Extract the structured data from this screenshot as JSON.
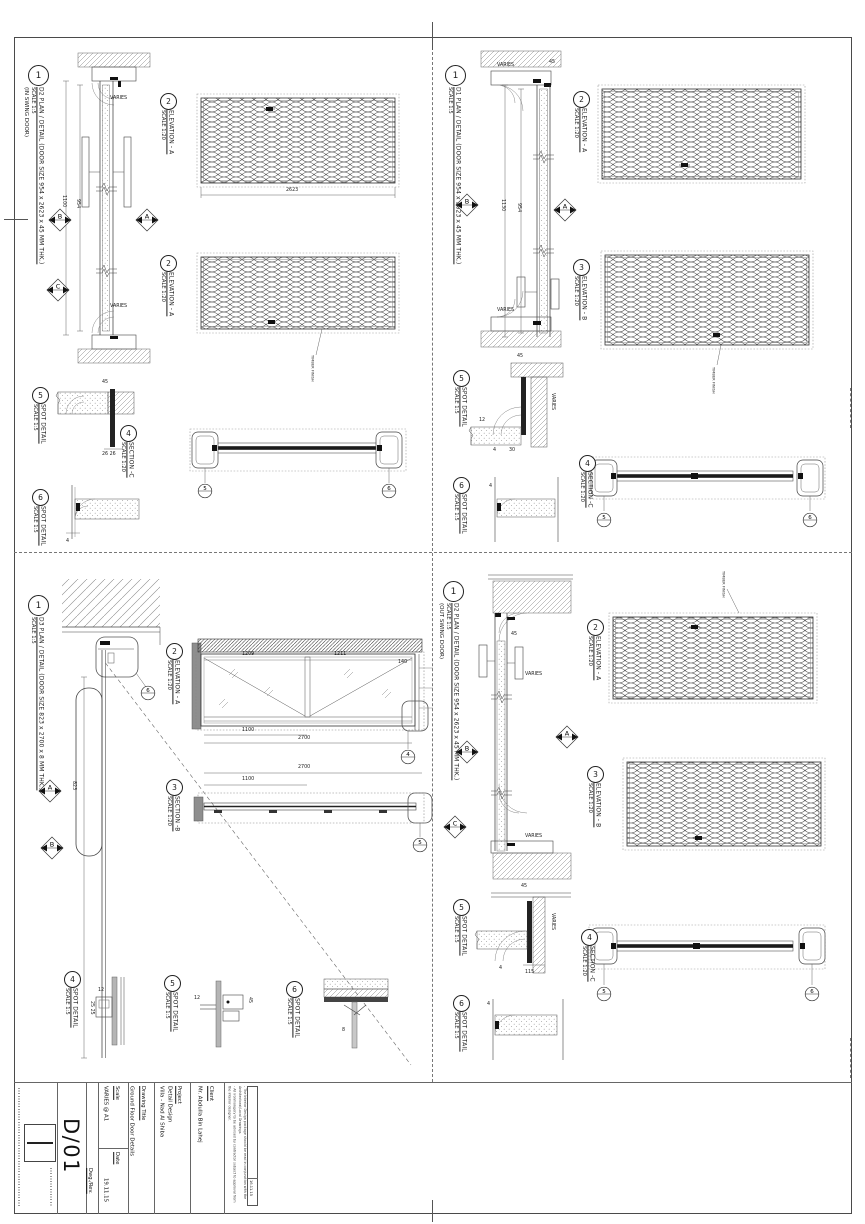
{
  "sheet": {
    "qtl": {
      "plan": {
        "num": "1",
        "title": "D2 PLAN / DETAIL (DOOR SIZE 954 x 2623 x 45 MM THK.)",
        "scale": "SCALE 1:5",
        "subtitle": "(IN SWING DOOR)"
      },
      "elev1": {
        "num": "2",
        "title": "ELEVATION - A",
        "scale": "SCALE 1:20"
      },
      "elev2": {
        "num": "2",
        "title": "ELEVATION - A",
        "scale": "SCALE 1:20"
      },
      "section": {
        "num": "4",
        "title": "SECTION -C",
        "scale": "SCALE 1:20"
      },
      "spot5": {
        "num": "5",
        "title": "SPOT DETAIL",
        "scale": "SCALE 1:5"
      },
      "spot6": {
        "num": "6",
        "title": "SPOT DETAIL",
        "scale": "SCALE 1:5"
      },
      "finish_label": "TIMBER FINISH",
      "dims": {
        "height": "1100",
        "door": "954",
        "panel": "2623",
        "varies1": "VARIES",
        "varies2": "VARIES",
        "t45": "45",
        "t26": "26  26",
        "t4": "4"
      },
      "markers": {
        "a": "A",
        "b": "B",
        "c": "C",
        "sec_left": "5",
        "sec_right": "6"
      }
    },
    "qtr": {
      "plan": {
        "num": "1",
        "title": "D1 PLAN / DETAIL (DOOR SIZE 954 x 2623 x 45 MM THK.)",
        "scale": "SCALE 1:5"
      },
      "elev1": {
        "num": "2",
        "title": "ELEVATION - A",
        "scale": "SCALE 1:20"
      },
      "elev2": {
        "num": "3",
        "title": "ELEVATION - B",
        "scale": "SCALE 1:20"
      },
      "section": {
        "num": "4",
        "title": "SECTION -C",
        "scale": "SCALE 1:20"
      },
      "spot5": {
        "num": "5",
        "title": "SPOT DETAIL",
        "scale": "SCALE 1:5"
      },
      "spot6": {
        "num": "6",
        "title": "SPOT DETAIL",
        "scale": "SCALE 1:5"
      },
      "finish_label": "TIMBER FINISH",
      "dims": {
        "height": "1130",
        "door": "954",
        "varies1": "VARIES",
        "varies2": "VARIES",
        "t45a": "45",
        "t45b": "45",
        "t12": "12",
        "t30": "30",
        "t4a": "4",
        "t4b": "4",
        "varies_spot": "VARIES"
      },
      "markers": {
        "a": "A",
        "b": "B",
        "sec_left": "5",
        "sec_right": "6"
      }
    },
    "qbl": {
      "plan": {
        "num": "1",
        "title": "D3 PLAN / DETAIL (DOOR SIZE 823 x 2700 x 8 MM THK.)",
        "scale": "SCALE 1:5"
      },
      "elev": {
        "num": "2",
        "title": "ELEVATION - A",
        "scale": "SCALE 1:20"
      },
      "section": {
        "num": "3",
        "title": "SECTION -B",
        "scale": "SCALE 1:20"
      },
      "spot4": {
        "num": "4",
        "title": "SPOT DETAIL",
        "scale": "SCALE 1:5"
      },
      "spot5": {
        "num": "5",
        "title": "SPOT DETAIL",
        "scale": "SCALE 1:5"
      },
      "spot6": {
        "num": "6",
        "title": "SPOT DETAIL",
        "scale": "SCALE 1:5"
      },
      "dims": {
        "door": "823",
        "p1": "1209",
        "p2": "1211",
        "p3": "140",
        "w1": "1100",
        "w2": "2700",
        "s1": "2700",
        "s2": "1100",
        "t12a": "12",
        "t25": "25  25",
        "t12b": "12",
        "t45": "45",
        "t8": "8"
      },
      "markers": {
        "a": "A",
        "b": "B",
        "top": "6",
        "elev": "4",
        "sec": "5"
      }
    },
    "qbr": {
      "plan": {
        "num": "1",
        "title": "D2 PLAN / DETAIL (DOOR SIZE 954 x 2623 x 45 MM THK.)",
        "scale": "SCALE 1:5",
        "subtitle": "(OUT SWING DOOR)"
      },
      "elev1": {
        "num": "2",
        "title": "ELEVATION - A",
        "scale": "SCALE 1:20"
      },
      "elev2": {
        "num": "3",
        "title": "ELEVATION - B",
        "scale": "SCALE 1:20"
      },
      "section": {
        "num": "4",
        "title": "SECTION -C",
        "scale": "SCALE 1:20"
      },
      "spot5": {
        "num": "5",
        "title": "SPOT DETAIL",
        "scale": "SCALE 1:5"
      },
      "spot6": {
        "num": "6",
        "title": "SPOT DETAIL",
        "scale": "SCALE 1:5"
      },
      "finish_label": "TIMBER FINISH",
      "dims": {
        "varies1": "VARIES",
        "varies2": "VARIES",
        "t45a": "45",
        "t45b": "45",
        "varies_spot": "VARIES",
        "t4a": "4",
        "t115": "115",
        "t4b": "4"
      },
      "markers": {
        "a": "A",
        "b": "B",
        "c": "C",
        "sec_left": "5",
        "sec_right": "6"
      }
    },
    "title_block": {
      "drawing_number": "D/01",
      "scale_label": "Scale",
      "scale_value": "VARIES @ A1",
      "date_label": "Date",
      "date_value": "19.11.15",
      "dwg_rev_label": "Dwg./Rev.",
      "drawing_title_label": "Drawing Title",
      "drawing_title_value": "Ground Floor Door Details",
      "project_label": "Project",
      "project_value1": "Detail Design",
      "project_value2": "Villa  - Nad Al Shiba",
      "client_label": "Client",
      "client_value": "Mr. Abdulla Bin Lahej",
      "notes": {
        "l0": "Note:",
        "l1": "- All dimensions should be checked on site prior to construction.",
        "l2": "- The Interior Design package should be read in conjunction with the Architectural/Local Drawings.",
        "l3": "- All ironmongery to be advised by contractor subject to approval from the interior designer."
      },
      "revision_date": "16.11.15"
    }
  }
}
